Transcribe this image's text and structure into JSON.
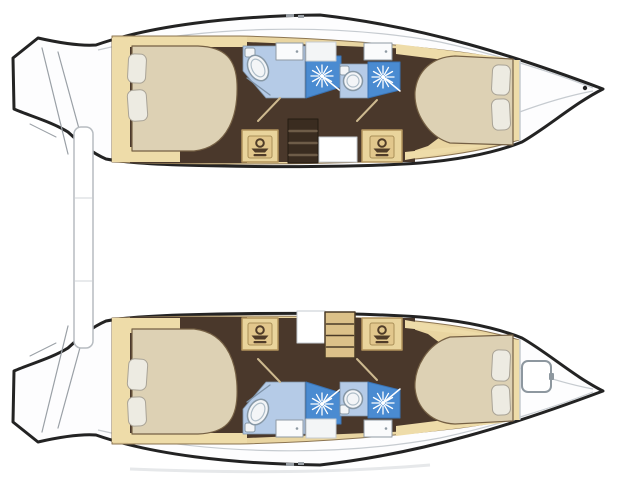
{
  "meta": {
    "description": "Catamaran yacht interior deck plan, overhead view, no text labels",
    "view": "top-down floor plan",
    "hull_count": 2
  },
  "legend": {
    "burst-icon": "shower spray head",
    "washbasin-icon": "washbasin / vanity",
    "oval-round-fixture": "toilet",
    "ladder-element": "companionway steps",
    "rounded-square-on-bow": "deck hatch (bottom hull only)",
    "vertical-bar-between-hulls": "aft crossbeam / davit bar"
  },
  "vessel": {
    "type": "catamaran",
    "hulls": [
      {
        "id": "top-hull",
        "rooms": [
          "stern transom steps",
          "aft double cabin with 2 pillows",
          "aft bathroom: toilet + shower + sink",
          "companionway steps (dark) + washbasin cabinets",
          "fwd bathroom: toilet + shower + sink",
          "fwd double cabin with 2 pillows",
          "bow deck with cleat"
        ]
      },
      {
        "id": "bottom-hull",
        "rooms": [
          "stern transom steps",
          "aft double cabin with 2 pillows",
          "aft bathroom: toilet + shower + sink",
          "companionway steps (tan) + washbasin cabinets",
          "fwd bathroom: toilet + shower + sink",
          "fwd double cabin with 2 pillows",
          "bow deck with hatch"
        ]
      }
    ]
  },
  "floorplan": {
    "viewbox": "0 0 640 480",
    "palette": {
      "outline": "#232323",
      "deck": "#fdfdfe",
      "white": "#ffffff",
      "lineGray": "#9aa0a6",
      "innerLine": "#c6cbd0",
      "wall": "#8c7552",
      "tanBase": "#e9d5a1",
      "tanStrip": "#eedca9",
      "cabinet": "#e9d49c",
      "cabinetEdge": "#b3945c",
      "floor": "#4a382b",
      "stepDark": "#3a2c20",
      "stepDarkEdge": "#241b12",
      "rungLight": "#6e5c48",
      "stepTan": "#dcc189",
      "stepTanEdge": "#4a3a27",
      "bed": "#ddd1b4",
      "bedEdge": "#756044",
      "pillow": "#edebe2",
      "pillowEdge": "#a9a396",
      "bathLight": "#b5cbe7",
      "bathEdge": "#7f93a8",
      "shower": "#4a8bd1",
      "showerEdge": "#3a73b4",
      "toilet": "#f3f5f7",
      "toiletEdge": "#8798a6",
      "seatEdge": "#aebdc8",
      "sink": "#fafbfc",
      "sinkEdge": "#8f9aa3",
      "panel": "#f3f5f6",
      "partition": "#cdb98f",
      "iconBrown": "#503c28",
      "iconPanel": "#e2c78c",
      "iconPanelEdge": "#a98f58",
      "hatchEdge": "#8d979f",
      "beamEdge": "#b7bcc1",
      "beamJoint": "#dadde0",
      "shadow": "#e6e8ea"
    },
    "icon_defs": {
      "washbasin": [
        {
          "name": "icon-panel",
          "shape": "rect",
          "x": -12,
          "y": -11,
          "w": 24,
          "h": 22,
          "rx": 2,
          "fill": "iconPanel",
          "stroke": "iconPanelEdge",
          "sw": 1
        },
        {
          "name": "icon-head",
          "shape": "circle",
          "cx": 0,
          "cy": -4,
          "r": 3.8,
          "fill": "none",
          "stroke": "iconBrown",
          "sw": 2
        },
        {
          "name": "icon-dish",
          "shape": "polygon",
          "points": "-8.5,1.5 8.5,1.5 5,5.5 -5,5.5",
          "fill": "iconBrown"
        },
        {
          "name": "icon-base",
          "shape": "rect",
          "x": -6.5,
          "y": 7,
          "w": 13,
          "h": 2.2,
          "rx": 1,
          "fill": "iconBrown"
        }
      ]
    },
    "hull_elements": [
      {
        "name": "hull-body",
        "shape": "path",
        "d": "M13,58 L38,38 C60,43 82,46 96,45 C150,26 230,16 320,15 C425,27 515,56 603,89 C575,103 548,127 522,142 C492,154 455,160 420,163 C350,168 250,167 180,165 C150,164 122,162 106,159 C92,153 80,143 68,132 C52,122 30,116 14,109 Z",
        "fill": "deck",
        "stroke": "outline",
        "sw": 3
      },
      {
        "name": "transom-step-line",
        "shape": "line",
        "x1": 42,
        "y1": 48,
        "x2": 68,
        "y2": 154,
        "stroke": "lineGray",
        "sw": 1.2
      },
      {
        "name": "transom-step-line",
        "shape": "line",
        "x1": 58,
        "y1": 52,
        "x2": 84,
        "y2": 147,
        "stroke": "lineGray",
        "sw": 1.2
      },
      {
        "name": "transom-step-line",
        "shape": "line",
        "x1": 30,
        "y1": 124,
        "x2": 56,
        "y2": 137,
        "stroke": "lineGray",
        "sw": 1
      },
      {
        "name": "deck-sheer-line",
        "shape": "path",
        "d": "M98,50 C200,26 330,22 440,42 C500,55 560,75 593,88",
        "fill": "none",
        "stroke": "innerLine",
        "sw": 1.2
      },
      {
        "name": "bow-deck-line",
        "shape": "path",
        "d": "M593,91 C545,100 490,122 445,144",
        "fill": "none",
        "stroke": "innerLine",
        "sw": 1.2
      },
      {
        "name": "interior-base",
        "shape": "path",
        "d": "M112,36 L240,36 C330,38 400,45 460,52 C490,56 508,60 519,62 L519,140 C490,149 450,156 405,160 C320,165 200,165 112,162 Z",
        "fill": "tanBase",
        "stroke": "wall",
        "sw": 1
      },
      {
        "name": "aft-cabin-floor",
        "shape": "rect",
        "x": 130,
        "y": 46,
        "w": 117,
        "h": 117,
        "fill": "floor"
      },
      {
        "name": "mid-floor",
        "shape": "polygon",
        "points": "247,42 415,49 415,162 247,162",
        "fill": "floor"
      },
      {
        "name": "fwd-cabin-floor",
        "shape": "polygon",
        "points": "398,50 468,62 452,128 428,146 398,156",
        "fill": "floor"
      },
      {
        "name": "headboard-strip",
        "shape": "rect",
        "x": 112,
        "y": 38,
        "w": 18,
        "h": 124,
        "fill": "tanStrip"
      },
      {
        "name": "aft-top-strip",
        "shape": "rect",
        "x": 128,
        "y": 37,
        "w": 119,
        "h": 10,
        "fill": "tanStrip"
      },
      {
        "name": "aft-bottom-strip",
        "shape": "rect",
        "x": 112,
        "y": 147,
        "w": 68,
        "h": 15,
        "fill": "tanStrip"
      },
      {
        "name": "fwd-top-strip",
        "shape": "polygon",
        "points": "396,44 500,57 519,61 519,70 468,63 396,54",
        "fill": "tanStrip"
      },
      {
        "name": "fwd-bottom-strip",
        "shape": "polygon",
        "points": "405,160 519,140 519,131 462,146 405,152",
        "fill": "tanStrip"
      },
      {
        "name": "fwd-head-strip",
        "shape": "rect",
        "x": 511,
        "y": 60,
        "w": 9,
        "h": 80,
        "fill": "tanStrip"
      },
      {
        "name": "bow-bulkhead-line",
        "shape": "line",
        "x1": 520,
        "y1": 61,
        "x2": 520,
        "y2": 140,
        "stroke": "innerLine",
        "sw": 1.5
      },
      {
        "name": "bathroom-aft-floor",
        "shape": "polygon",
        "points": "243,46 305,46 305,98 266,98 243,71",
        "fill": "bathLight",
        "stroke": "bathEdge",
        "sw": 0.8
      },
      {
        "name": "bathroom-aft-door-line",
        "shape": "line",
        "x1": 247,
        "y1": 78,
        "x2": 270,
        "y2": 95,
        "stroke": "bathEdge",
        "sw": 1.3
      },
      {
        "name": "shower-aft-floor",
        "shape": "polygon",
        "points": "306,56 341,56 341,87 306,98",
        "fill": "shower",
        "stroke": "showerEdge",
        "sw": 1
      },
      {
        "name": "shower-spray-icon",
        "shape": "burst",
        "cx": 322,
        "cy": 76,
        "r1": 3,
        "r2": 11,
        "n": 12
      },
      {
        "name": "shower-wand-line",
        "shape": "line",
        "x1": 322,
        "y1": 76,
        "x2": 343,
        "y2": 93,
        "stroke": "white",
        "sw": 1.5
      },
      {
        "name": "toilet-aft-tank",
        "shape": "rect",
        "x": 245,
        "y": 48,
        "w": 10,
        "h": 9,
        "rx": 2,
        "fill": "toilet",
        "stroke": "toiletEdge",
        "sw": 1
      },
      {
        "name": "toilet-aft",
        "shape": "ellipse",
        "cx": 258,
        "cy": 68,
        "rx": 9.5,
        "ry": 13.5,
        "rot": -28,
        "fill": "toilet",
        "stroke": "toiletEdge",
        "sw": 1.5
      },
      {
        "name": "toilet-aft-seat",
        "shape": "ellipse",
        "cx": 258,
        "cy": 68,
        "rx": 6,
        "ry": 9.5,
        "rot": -28,
        "fill": "none",
        "stroke": "seatEdge",
        "sw": 1.2
      },
      {
        "name": "sink-aft-unit",
        "shape": "rect",
        "x": 276,
        "y": 43,
        "w": 27,
        "h": 17,
        "fill": "sink",
        "stroke": "sinkEdge",
        "sw": 1
      },
      {
        "name": "sink-aft-drain",
        "shape": "circle",
        "cx": 297,
        "cy": 51.5,
        "r": 1.3,
        "fill": "sinkEdge"
      },
      {
        "name": "mid-window-panel",
        "shape": "rect",
        "x": 306,
        "y": 42,
        "w": 30,
        "h": 19,
        "fill": "panel",
        "stroke": "innerLine",
        "sw": 1
      },
      {
        "name": "sink-fwd-unit",
        "shape": "rect",
        "x": 364,
        "y": 43,
        "w": 28,
        "h": 17,
        "fill": "sink",
        "stroke": "sinkEdge",
        "sw": 1
      },
      {
        "name": "sink-fwd-drain",
        "shape": "circle",
        "cx": 386,
        "cy": 51.5,
        "r": 1.3,
        "fill": "sinkEdge"
      },
      {
        "name": "bathroom-fwd-floor",
        "shape": "polygon",
        "points": "340,64 368,64 368,98 340,98",
        "fill": "bathLight",
        "stroke": "bathEdge",
        "sw": 0.8
      },
      {
        "name": "toilet-fwd-tank",
        "shape": "rect",
        "x": 340,
        "y": 66,
        "w": 9,
        "h": 9,
        "rx": 2,
        "fill": "toilet",
        "stroke": "toiletEdge",
        "sw": 1
      },
      {
        "name": "toilet-fwd",
        "shape": "circle",
        "cx": 353,
        "cy": 81,
        "r": 9.5,
        "fill": "toilet",
        "stroke": "toiletEdge",
        "sw": 1.5
      },
      {
        "name": "toilet-fwd-seat",
        "shape": "circle",
        "cx": 353,
        "cy": 81,
        "r": 6,
        "fill": "none",
        "stroke": "seatEdge",
        "sw": 1.2
      },
      {
        "name": "shower-fwd-floor",
        "shape": "polygon",
        "points": "368,62 400,62 400,90 368,98",
        "fill": "shower",
        "stroke": "showerEdge",
        "sw": 1
      },
      {
        "name": "shower-spray-icon",
        "shape": "burst",
        "cx": 383,
        "cy": 77,
        "r1": 3,
        "r2": 11,
        "n": 12
      },
      {
        "name": "shower-wand-line",
        "shape": "line",
        "x1": 383,
        "y1": 77,
        "x2": 400,
        "y2": 91,
        "stroke": "white",
        "sw": 1.5
      },
      {
        "name": "partition-line-left",
        "shape": "line",
        "x1": 280,
        "y1": 98,
        "x2": 258,
        "y2": 121,
        "stroke": "partition",
        "sw": 2
      },
      {
        "name": "partition-line-right",
        "shape": "line",
        "x1": 377,
        "y1": 100,
        "x2": 357,
        "y2": 121,
        "stroke": "partition",
        "sw": 2
      },
      {
        "name": "vanity-cabinet-aft",
        "shape": "rect",
        "x": 242,
        "y": 130,
        "w": 36,
        "h": 32,
        "fill": "cabinet",
        "stroke": "cabinetEdge",
        "sw": 1.5
      },
      {
        "name": "vanity-cabinet-fwd",
        "shape": "rect",
        "x": 362,
        "y": 130,
        "w": 40,
        "h": 32,
        "fill": "cabinet",
        "stroke": "cabinetEdge",
        "sw": 1.5
      },
      {
        "name": "double-berth-aft",
        "shape": "path",
        "d": "M132,46 L198,46 C226,47 236,60 237,84 C238,112 230,147 194,151 L132,151 Z",
        "fill": "bed",
        "stroke": "bedEdge",
        "sw": 1.2
      },
      {
        "name": "pillow",
        "shape": "rect",
        "x": 128,
        "y": 54,
        "w": 18,
        "h": 29,
        "rx": 6,
        "rot": 3,
        "fill": "pillow",
        "stroke": "pillowEdge",
        "sw": 1
      },
      {
        "name": "pillow",
        "shape": "rect",
        "x": 128,
        "y": 90,
        "w": 19,
        "h": 31,
        "rx": 6,
        "rot": -4,
        "fill": "pillow",
        "stroke": "pillowEdge",
        "sw": 1
      },
      {
        "name": "double-berth-fwd",
        "shape": "path",
        "d": "M513,59 L455,56 C432,57 417,71 415,92 C414,112 427,136 450,143 L513,145 Z",
        "fill": "bed",
        "stroke": "bedEdge",
        "sw": 1.2
      },
      {
        "name": "pillow",
        "shape": "rect",
        "x": 492,
        "y": 65,
        "w": 18,
        "h": 30,
        "rx": 6,
        "rot": 3,
        "fill": "pillow",
        "stroke": "pillowEdge",
        "sw": 1
      },
      {
        "name": "pillow",
        "shape": "rect",
        "x": 492,
        "y": 99,
        "w": 18,
        "h": 31,
        "rx": 6,
        "rot": -3,
        "fill": "pillow",
        "stroke": "pillowEdge",
        "sw": 1
      },
      {
        "name": "deck-fitting",
        "shape": "rect",
        "x": 286,
        "y": 14,
        "w": 8,
        "h": 3,
        "fill": "lineGray"
      },
      {
        "name": "deck-fitting",
        "shape": "rect",
        "x": 298,
        "y": 15,
        "w": 6,
        "h": 3,
        "fill": "lineGray"
      }
    ],
    "overlay_top": [
      {
        "name": "companionway-steps",
        "shape": "rect",
        "x": 288,
        "y": 119,
        "w": 30,
        "h": 44,
        "fill": "stepDark",
        "stroke": "stepDarkEdge",
        "sw": 1
      },
      {
        "name": "step-rung",
        "shape": "line",
        "x1": 289.5,
        "y1": 131,
        "x2": 316.5,
        "y2": 131,
        "stroke": "rungLight",
        "sw": 2.5
      },
      {
        "name": "step-rung",
        "shape": "line",
        "x1": 289.5,
        "y1": 143,
        "x2": 316.5,
        "y2": 143,
        "stroke": "rungLight",
        "sw": 2.5
      },
      {
        "name": "step-rung",
        "shape": "line",
        "x1": 289.5,
        "y1": 155,
        "x2": 316.5,
        "y2": 155,
        "stroke": "rungLight",
        "sw": 2.5
      },
      {
        "name": "entry-landing",
        "shape": "rect",
        "x": 319,
        "y": 137,
        "w": 38,
        "h": 25,
        "fill": "white",
        "stroke": "innerLine",
        "sw": 1
      },
      {
        "name": "washbasin-icon",
        "shape": "icon",
        "ref": "washbasin",
        "x": 260,
        "y": 147
      },
      {
        "name": "washbasin-icon",
        "shape": "icon",
        "ref": "washbasin",
        "x": 382,
        "y": 147
      },
      {
        "name": "bow-cleat",
        "shape": "circle",
        "cx": 585,
        "cy": 88,
        "r": 2.2,
        "fill": "outline"
      }
    ],
    "overlay_bottom": [
      {
        "name": "entry-landing",
        "shape": "rect",
        "x": 297,
        "y": 311,
        "w": 28,
        "h": 32,
        "fill": "white",
        "stroke": "innerLine",
        "sw": 1
      },
      {
        "name": "companionway-steps",
        "shape": "rect",
        "x": 325,
        "y": 312,
        "w": 30,
        "h": 46,
        "fill": "stepTan",
        "stroke": "stepTanEdge",
        "sw": 1.5
      },
      {
        "name": "step-rung",
        "shape": "line",
        "x1": 326.5,
        "y1": 324,
        "x2": 353.5,
        "y2": 324,
        "stroke": "stepTanEdge",
        "sw": 1.5
      },
      {
        "name": "step-rung",
        "shape": "line",
        "x1": 326.5,
        "y1": 335.5,
        "x2": 353.5,
        "y2": 335.5,
        "stroke": "stepTanEdge",
        "sw": 1.5
      },
      {
        "name": "step-rung",
        "shape": "line",
        "x1": 326.5,
        "y1": 347,
        "x2": 353.5,
        "y2": 347,
        "stroke": "stepTanEdge",
        "sw": 1.5
      },
      {
        "name": "washbasin-icon",
        "shape": "icon",
        "ref": "washbasin",
        "x": 260,
        "y": 334
      },
      {
        "name": "washbasin-icon",
        "shape": "icon",
        "ref": "washbasin",
        "x": 382,
        "y": 334
      },
      {
        "name": "bow-hatch",
        "shape": "rect",
        "x": 522,
        "y": 361,
        "w": 29,
        "h": 31,
        "rx": 6,
        "fill": "white",
        "stroke": "hatchEdge",
        "sw": 2
      },
      {
        "name": "bow-hatch-latch",
        "shape": "rect",
        "x": 549,
        "y": 373,
        "w": 5,
        "h": 7,
        "rx": 1,
        "fill": "hatchEdge"
      }
    ],
    "overlay_shared": [
      {
        "name": "aft-crossbeam",
        "shape": "rect",
        "x": 74,
        "y": 127,
        "w": 19,
        "h": 221,
        "rx": 7,
        "fill": "white",
        "stroke": "beamEdge",
        "sw": 1.5
      },
      {
        "name": "beam-joint-line",
        "shape": "line",
        "x1": 75.5,
        "y1": 198,
        "x2": 91.5,
        "y2": 198,
        "stroke": "beamJoint",
        "sw": 1.2
      },
      {
        "name": "beam-joint-line",
        "shape": "line",
        "x1": 75.5,
        "y1": 281,
        "x2": 91.5,
        "y2": 281,
        "stroke": "beamJoint",
        "sw": 1.2
      },
      {
        "name": "hull-shadow",
        "shape": "path",
        "d": "M130,469 Q300,476 430,465",
        "fill": "none",
        "stroke": "shadow",
        "sw": 3
      }
    ]
  }
}
